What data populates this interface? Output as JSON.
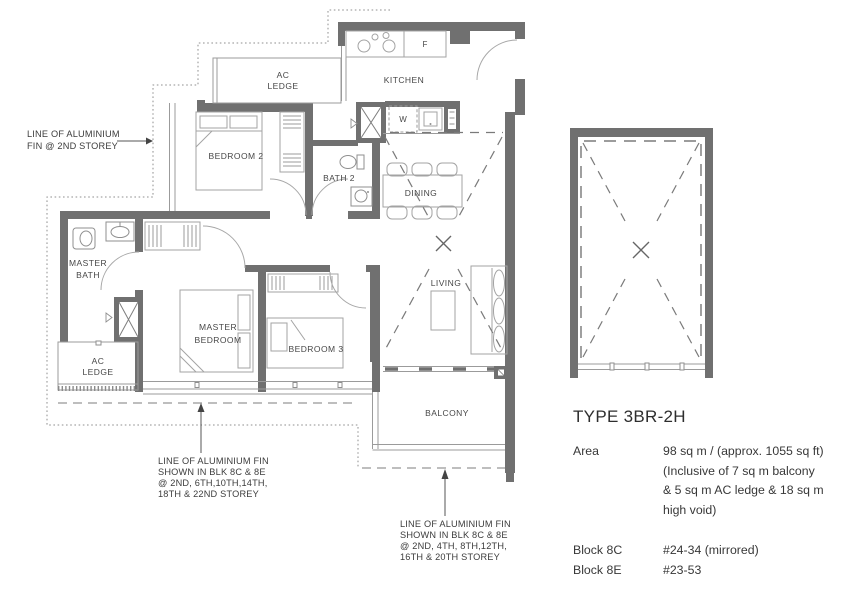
{
  "colors": {
    "wall": "#707070",
    "line": "#9b9b9b",
    "text": "#474747",
    "background": "#ffffff"
  },
  "rooms": {
    "ac_ledge_top_l1": "AC",
    "ac_ledge_top_l2": "LEDGE",
    "kitchen": "KITCHEN",
    "fridge": "F",
    "washer": "W",
    "bedroom2": "BEDROOM 2",
    "bath2": "BATH 2",
    "dining": "DINING",
    "living": "LIVING",
    "master_bath_l1": "MASTER",
    "master_bath_l2": "BATH",
    "master_bedroom_l1": "MASTER",
    "master_bedroom_l2": "BEDROOM",
    "bedroom3": "BEDROOM 3",
    "ac_ledge_bottom_l1": "AC",
    "ac_ledge_bottom_l2": "LEDGE",
    "balcony": "BALCONY"
  },
  "annotations": {
    "fin_left_l1": "LINE OF ALUMINIUM",
    "fin_left_l2": "FIN @ 2ND STOREY",
    "fin_bl_l1": "LINE OF ALUMINIUM FIN",
    "fin_bl_l2": "SHOWN IN BLK 8C & 8E",
    "fin_bl_l3": "@ 2ND, 6TH,10TH,14TH,",
    "fin_bl_l4": "18TH & 22ND STOREY",
    "fin_bm_l1": "LINE OF ALUMINIUM FIN",
    "fin_bm_l2": "SHOWN IN BLK 8C & 8E",
    "fin_bm_l3": "@ 2ND, 4TH, 8TH,12TH,",
    "fin_bm_l4": "16TH & 20TH STOREY"
  },
  "info": {
    "title": "TYPE 3BR-2H",
    "area_label": "Area",
    "area_l1": "98 sq m / (approx. 1055 sq ft)",
    "area_l2": "(Inclusive of 7 sq m balcony",
    "area_l3": "& 5 sq m AC ledge & 18 sq m",
    "area_l4": "high void)",
    "block1_label": "Block 8C",
    "block1_value": "#24-34 (mirrored)",
    "block2_label": "Block 8E",
    "block2_value": "#23-53"
  }
}
